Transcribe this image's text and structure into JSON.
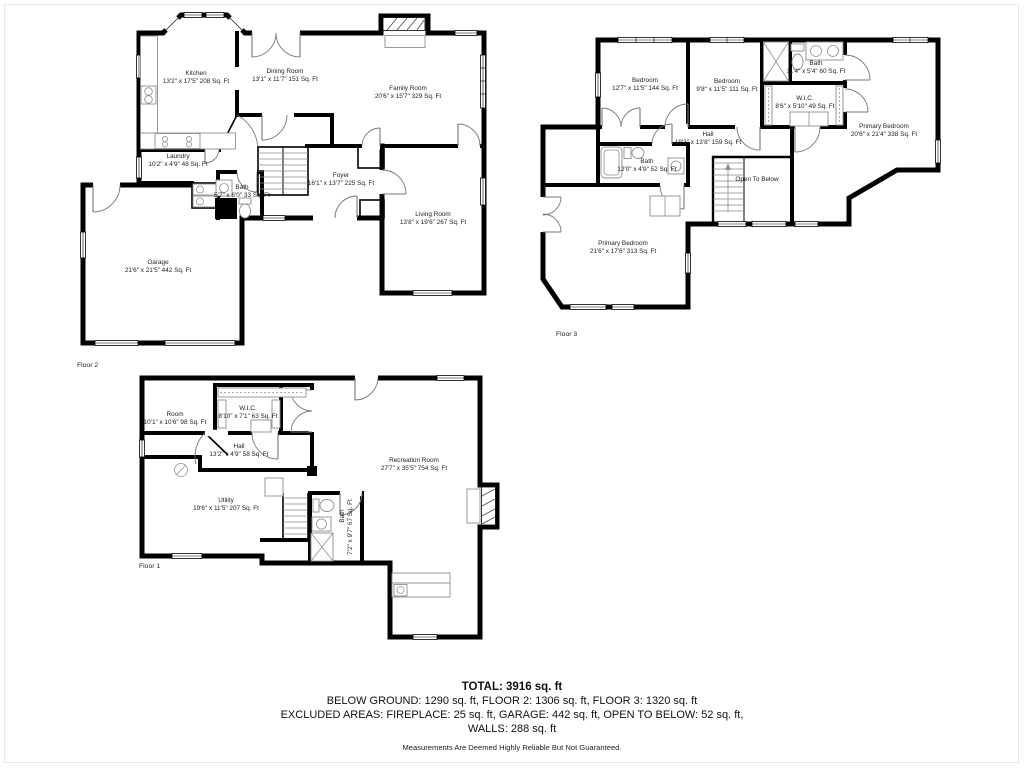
{
  "colors": {
    "wall": "#000000",
    "background": "#ffffff",
    "fixture": "#909090"
  },
  "floors": [
    {
      "label": "Floor 2",
      "rooms": [
        {
          "name": "Kitchen",
          "dims": "13'2\" x 17'5\" 208 Sq. Ft"
        },
        {
          "name": "Dining Room",
          "dims": "13'1\" x 11'7\" 151 Sq. Ft"
        },
        {
          "name": "Family Room",
          "dims": "20'6\" x 15'7\" 329 Sq. Ft"
        },
        {
          "name": "Laundry",
          "dims": "10'2\" x 4'9\" 48 Sq. Ft"
        },
        {
          "name": "Bath",
          "dims": "5'7\" x 6'0\" 33 Sq. Ft"
        },
        {
          "name": "Foyer",
          "dims": "16'1\" x 13'7\" 225 Sq. Ft"
        },
        {
          "name": "Living Room",
          "dims": "13'8\" x 19'6\" 267 Sq. Ft"
        },
        {
          "name": "Garage",
          "dims": "21'6\" x 21'5\" 442 Sq. Ft"
        }
      ]
    },
    {
      "label": "Floor 3",
      "rooms": [
        {
          "name": "Bedroom",
          "dims": "12'7\" x 11'5\" 144 Sq. Ft"
        },
        {
          "name": "Bedroom",
          "dims": "9'8\" x 11'5\" 111 Sq. Ft"
        },
        {
          "name": "Bath",
          "dims": "11'4\" x 5'4\" 60 Sq. Ft"
        },
        {
          "name": "W.I.C.",
          "dims": "8'6\" x 5'10\" 49 Sq. Ft"
        },
        {
          "name": "Primary Bedroom",
          "dims": "20'6\" x 21'4\" 338 Sq. Ft"
        },
        {
          "name": "Hall",
          "dims": "19'3\" x 13'8\" 159 Sq. Ft"
        },
        {
          "name": "Bath",
          "dims": "12'0\" x 4'9\" 52 Sq. Ft"
        },
        {
          "name": "Open To Below",
          "dims": ""
        },
        {
          "name": "Primary Bedroom",
          "dims": "21'6\" x 17'6\" 313 Sq. Ft"
        }
      ]
    },
    {
      "label": "Floor 1",
      "rooms": [
        {
          "name": "Room",
          "dims": "10'1\" x 10'6\" 98 Sq. Ft"
        },
        {
          "name": "W.I.C.",
          "dims": "8'10\" x 7'1\" 63 Sq. Ft"
        },
        {
          "name": "Hall",
          "dims": "13'2\" x 4'9\" 58 Sq. Ft"
        },
        {
          "name": "Utility",
          "dims": "19'6\" x 11'5\" 207 Sq. Ft"
        },
        {
          "name": "Recreation Room",
          "dims": "27'7\" x 35'5\" 754 Sq. Ft"
        },
        {
          "name": "Bath",
          "dims": "7'2\" x 9'7\" 67 Sq. Ft"
        }
      ]
    }
  ],
  "summary": {
    "total": "TOTAL: 3916 sq. ft",
    "line1": "BELOW GROUND: 1290 sq. ft, FLOOR 2: 1306 sq. ft, FLOOR 3: 1320 sq. ft",
    "line2": "EXCLUDED AREAS: FIREPLACE: 25 sq. ft, GARAGE: 442 sq. ft, OPEN TO BELOW: 52 sq. ft,",
    "line3": "WALLS: 288 sq. ft",
    "disclaimer": "Measurements Are Deemed Highly Reliable But Not Guaranteed."
  }
}
